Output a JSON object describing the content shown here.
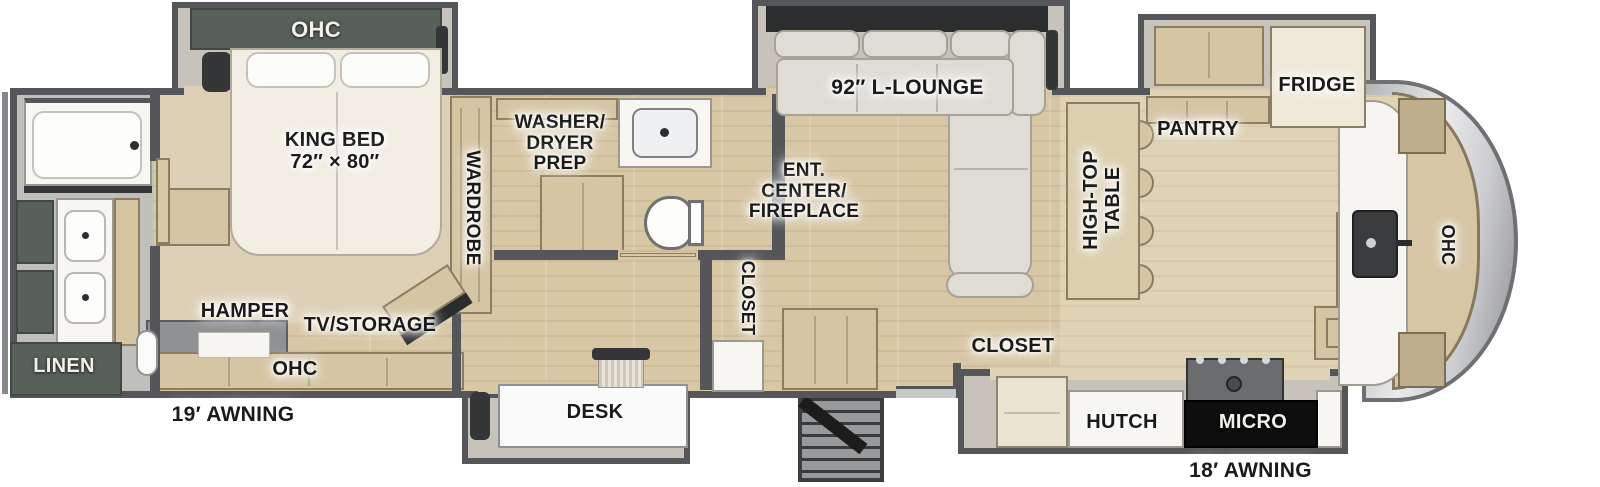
{
  "plan_title": "Fifth wheel RV floor plan",
  "colors": {
    "wall": "#54565a",
    "floor_wood": "#d8c7a4",
    "carpet": "#ddd0b6",
    "cabinet_tan": "#d5c5a2",
    "sage_green": "#57615a",
    "sofa_gray": "#dedcd4",
    "label_black": "#1a1a1a",
    "micro_black": "#0e0e0f"
  },
  "bedroom": {
    "ohc": "OHC",
    "king_bed": "KING BED\n72″ × 80″",
    "wardrobe": "WARDROBE",
    "hamper": "HAMPER",
    "tv_storage": "TV/STORAGE",
    "ohc_base": "OHC"
  },
  "rear_bath": {
    "linen": "LINEN"
  },
  "mid_bath": {
    "washer_dryer_prep": "WASHER/\nDRYER\nPREP"
  },
  "living": {
    "lounge": "92″ L-LOUNGE",
    "ent_center": "ENT.\nCENTER/\nFIREPLACE",
    "closet": "CLOSET",
    "high_top_table": "HIGH-TOP\nTABLE"
  },
  "kitchen": {
    "pantry": "PANTRY",
    "fridge": "FRIDGE",
    "ohc": "OHC",
    "closet": "CLOSET",
    "hutch": "HUTCH",
    "micro": "MICRO"
  },
  "office": {
    "desk": "DESK"
  },
  "exterior": {
    "awning_off_door": "19′ AWNING",
    "awning_door": "18′ AWNING"
  }
}
